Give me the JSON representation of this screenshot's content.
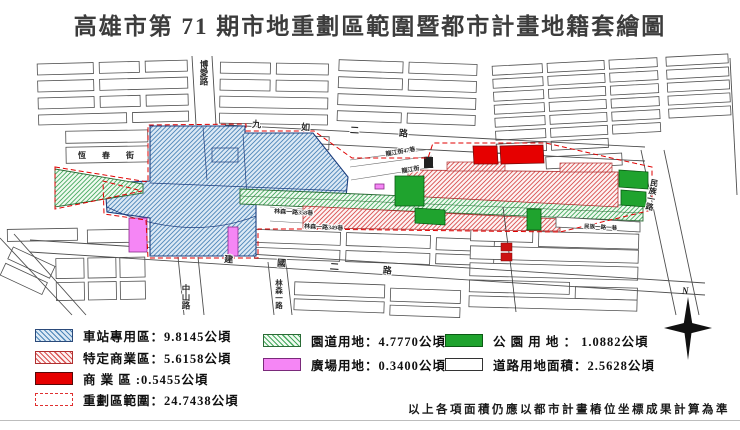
{
  "title": "高雄市第 71 期市地重劃區範圍暨都市計畫地籍套繪圖",
  "map": {
    "roads": {
      "boai": "博愛路",
      "jiuru": "九如二路",
      "hengchun": "恆春街",
      "longjiang_lane47": "龍江街47巷",
      "longjiang": "龍江街",
      "linsen_lane358": "林森一路358巷",
      "linsen_lane349": "林森一路349巷",
      "jianguo": "建國二路",
      "zhongshan": "中山路",
      "linsen": "林森一路",
      "minzu": "民族一路",
      "minzu_lane1": "民族一路一巷"
    },
    "compass_label": "N"
  },
  "legend": {
    "items": [
      {
        "key": "station",
        "label": "車站專用區：9.8145公頃"
      },
      {
        "key": "special_commercial",
        "label": "特定商業區：5.6158公頃"
      },
      {
        "key": "commercial",
        "label": "商 業 區 :0.5455公頃"
      },
      {
        "key": "boundary",
        "label": "重劃區範圍：24.7438公頃"
      },
      {
        "key": "parkway",
        "label": "園道用地：4.7770公頃"
      },
      {
        "key": "plaza",
        "label": "廣場用地：0.3400公頃"
      },
      {
        "key": "park",
        "label": "公 園 用 地 ： 1.0882公頃"
      },
      {
        "key": "road",
        "label": "道路用地面積：2.5628公頃"
      }
    ]
  },
  "footnote": "以上各項面積仍應以都市計畫樁位坐標成果計算為準",
  "colors": {
    "station_hatch": "#4d86b8",
    "special_commercial_hatch": "#d95050",
    "commercial_fill": "#e60000",
    "parkway_hatch": "#46a95f",
    "plaza_fill": "#f586f5",
    "park_fill": "#1fa32e",
    "boundary_dash": "#e00000"
  }
}
